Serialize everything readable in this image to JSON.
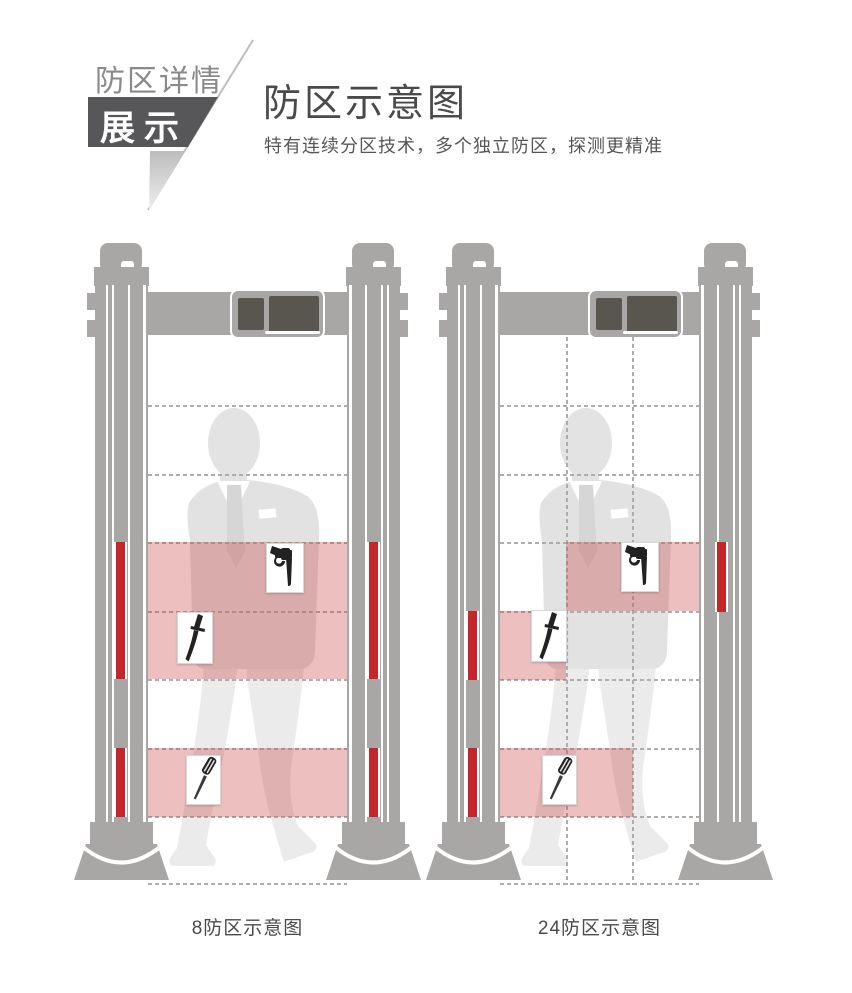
{
  "page": {
    "background": "#ffffff"
  },
  "header": {
    "badge_label": "防区详情",
    "badge_box_label": "展示",
    "title": "防区示意图",
    "subtitle": "特有连续分区技术，多个独立防区，探测更精准"
  },
  "gates": [
    {
      "id": "8-zone",
      "caption": "8防区示意图",
      "zone_count": 8,
      "detected_items": [
        "revolver",
        "dagger",
        "screwdriver"
      ]
    },
    {
      "id": "24-zone",
      "caption": "24防区示意图",
      "zone_count": 24,
      "detected_items": [
        "revolver",
        "dagger",
        "screwdriver"
      ]
    }
  ],
  "icons": {
    "revolver": "revolver-icon",
    "dagger": "dagger-icon",
    "screwdriver": "screwdriver-icon"
  },
  "colors": {
    "page_bg": "#ffffff",
    "frame_gray": "#a9a6a6",
    "screen_dark": "#59554f",
    "alarm_red": "#c4262b",
    "zone_pink": "rgba(199,62,62,0.33)",
    "silhouette": "#e3e3e3",
    "silhouette_light": "#ebebeb",
    "badge_dark": "#57575a",
    "text_dark": "#4a4a4a",
    "text_mid": "#575757",
    "text_gray": "#8a8a8a",
    "dash": "#adadad",
    "card_border": "#d8d8d8"
  }
}
